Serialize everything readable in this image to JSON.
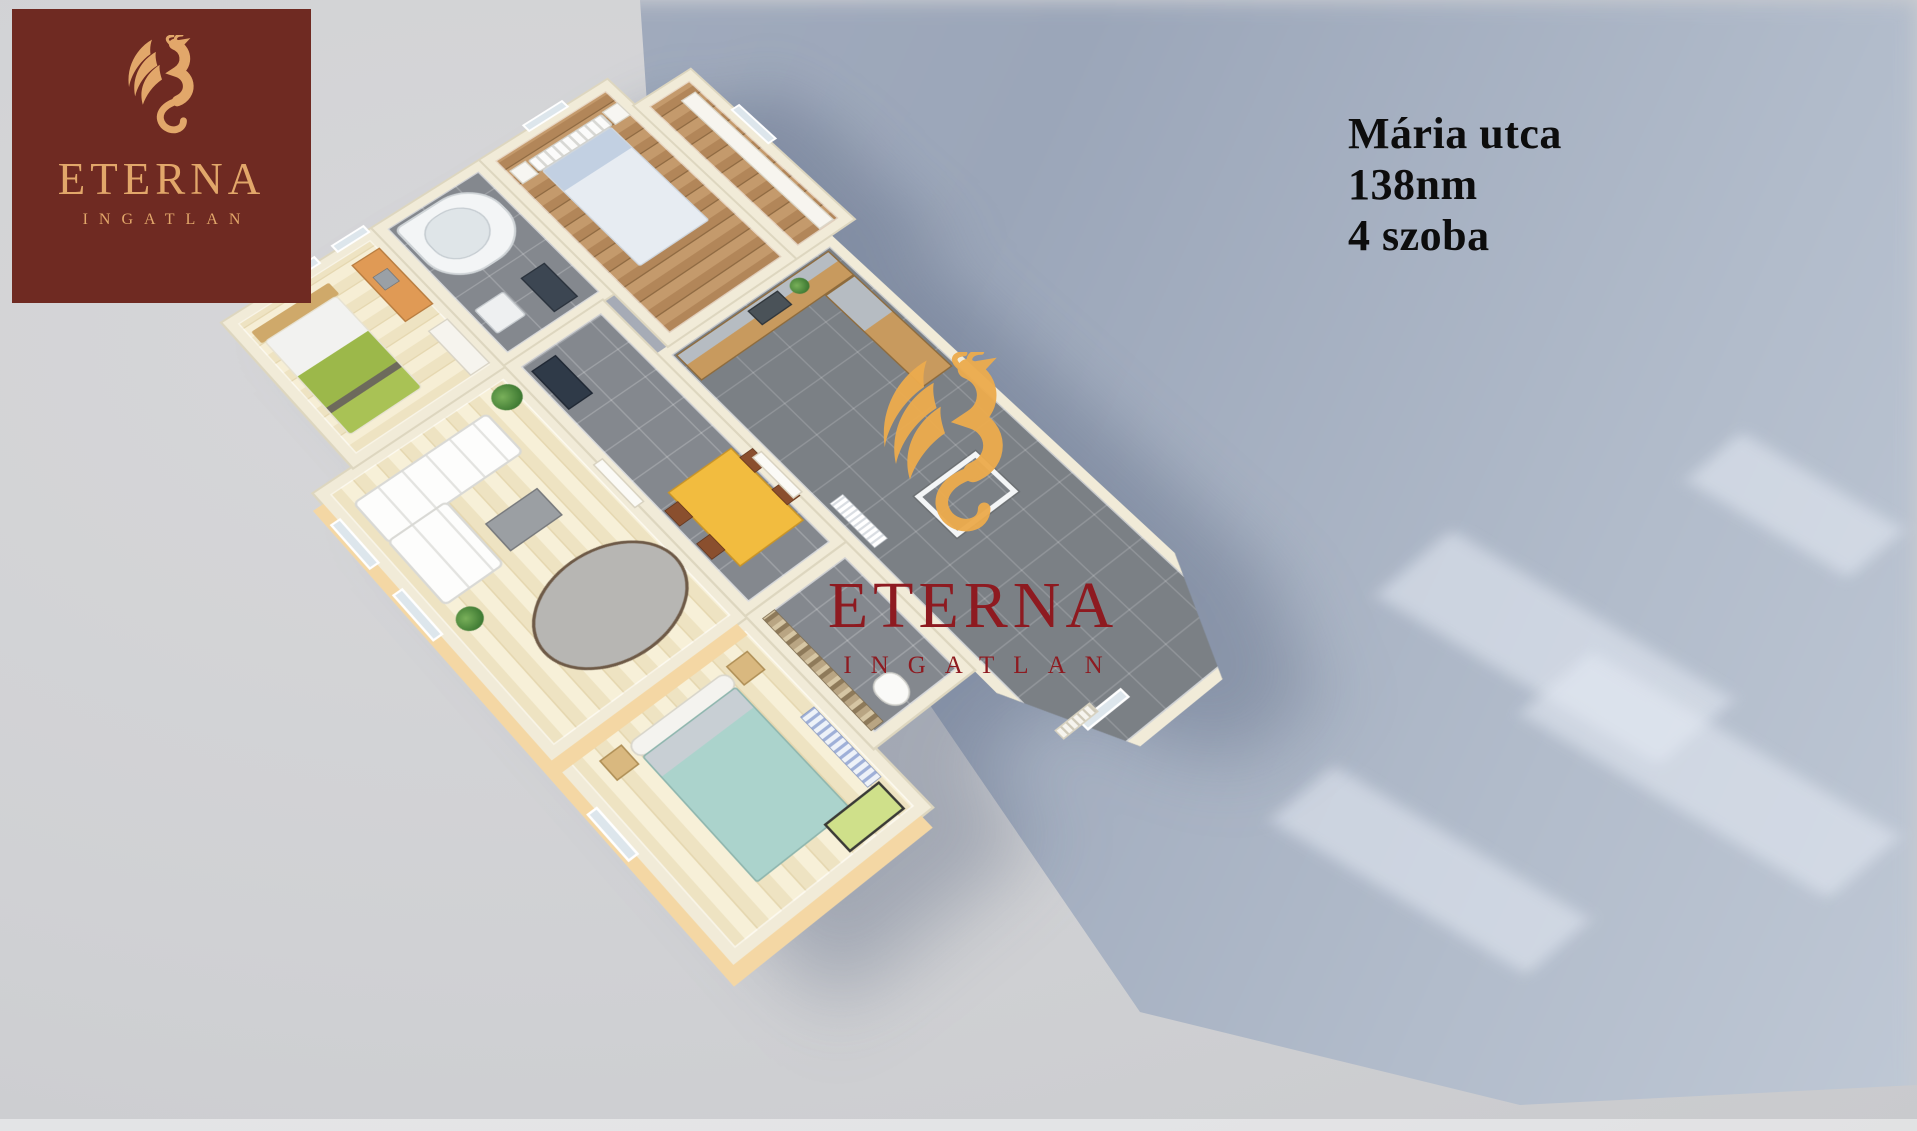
{
  "image_type": "3d-floorplan-real-estate-render",
  "colors": {
    "background": "#d2d2d4",
    "cast_shadow": "#a3adbf",
    "shadow_light_streak": "#cdd5e1",
    "wall": "#f1ebd8",
    "wall_outer_peach": "#f4d7a4",
    "floor_light_wood": "#eee3c2",
    "floor_dark_wood": "#b28659",
    "floor_gray_tile": "#84888e",
    "logo_background": "#6f2a22",
    "logo_gold": "#e2a76a",
    "watermark_red": "#8e1a20",
    "watermark_gold": "#ecab4e",
    "dining_table_yellow": "#f2bc3f",
    "bed_green": "#9cb84a",
    "bed_teal": "#abd3cc",
    "bed_blue": "#c2d0e2"
  },
  "logo_card": {
    "brand": "ETERNA",
    "subtitle": "INGATLAN"
  },
  "property_info": {
    "street": "Mária utca",
    "area": "138nm",
    "rooms": "4 szoba"
  },
  "watermark": {
    "brand": "ETERNA",
    "subtitle": "INGATLAN"
  },
  "floorplan": {
    "style": "isometric 3d cutaway, viewed from above, rotated ~40deg",
    "rooms": [
      {
        "name": "bedroom-children",
        "floor": "light-wood",
        "furniture": [
          "double-bed-green-white",
          "wood-headboard",
          "orange-desk-with-laptop",
          "white-wardrobe"
        ]
      },
      {
        "name": "bathroom",
        "floor": "gray-tile",
        "furniture": [
          "corner-bathtub",
          "washing-machine",
          "dark-cabinet"
        ]
      },
      {
        "name": "bedroom-guest",
        "floor": "dark-wood",
        "furniture": [
          "white-frame-bed-blue-pillows",
          "nightstand-white-x2"
        ]
      },
      {
        "name": "dressing-room",
        "floor": "dark-wood",
        "furniture": [
          "white-shelf"
        ]
      },
      {
        "name": "living-room",
        "floor": "light-wood",
        "furniture": [
          "white-corner-sofa",
          "gray-coffee-table",
          "oval-gray-rug",
          "potted-palm",
          "potted-plant"
        ]
      },
      {
        "name": "hallway-dining",
        "floor": "gray-tile",
        "furniture": [
          "yellow-dining-table",
          "brown-chairs-x4",
          "dark-mirror-cabinet"
        ]
      },
      {
        "name": "bedroom-master",
        "floor": "light-wood",
        "furniture": [
          "double-bed-teal",
          "wood-nightstand-x2",
          "green-baby-crib",
          "radiator"
        ]
      },
      {
        "name": "wc",
        "floor": "gray-tile",
        "furniture": [
          "toilet",
          "stone-mosaic-wall"
        ]
      },
      {
        "name": "kitchen-bay",
        "floor": "gray-tile",
        "furniture": [
          "l-shaped-wood-counter",
          "sink",
          "small-plant",
          "white-glass-table-frame",
          "white-radiator",
          "louvered-entry-door",
          "bay-windows"
        ]
      }
    ]
  }
}
